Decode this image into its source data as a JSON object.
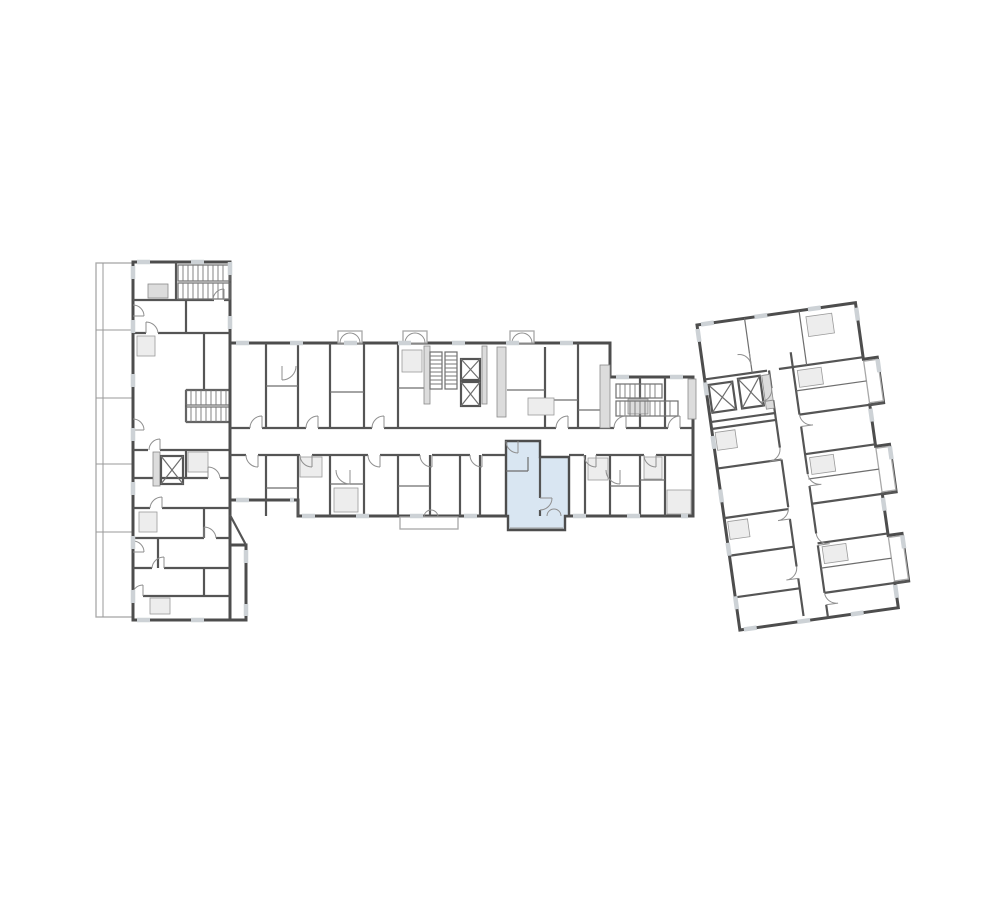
{
  "page": {
    "background": "#ffffff"
  },
  "colors": {
    "wall_dark": "#4d4d4d",
    "wall_medium": "#6e6e6e",
    "wall_light": "#a8a8a8",
    "window_gap": "#cdd2d6",
    "hatch_fill": "#ededed",
    "shaft_fill": "#dcdcdc",
    "highlight_fill": "#d9e6f2"
  },
  "plan": {
    "type": "architectural-floor-plan",
    "highlighted_unit": {
      "label": "selected-apartment",
      "fill": "#d9e6f2"
    },
    "wings": [
      {
        "id": "left-wing",
        "orientation": "vertical"
      },
      {
        "id": "central-bar",
        "orientation": "horizontal"
      },
      {
        "id": "right-wing",
        "orientation": "angled"
      }
    ]
  }
}
